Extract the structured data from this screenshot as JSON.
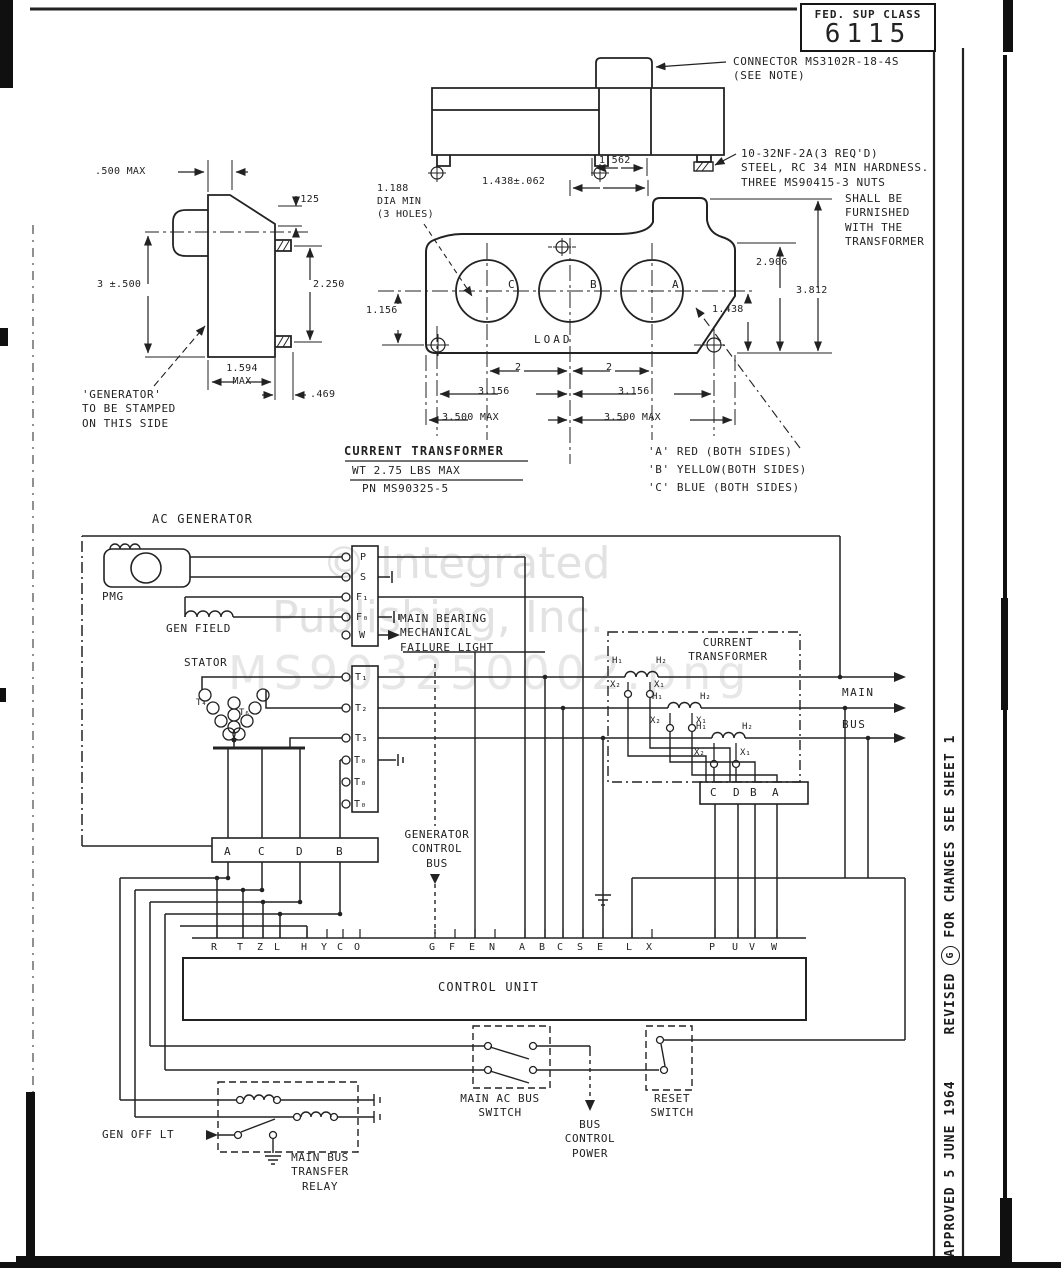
{
  "page": {
    "fed_box": {
      "label": "FED. SUP CLASS",
      "value": "6115"
    },
    "edge_note": {
      "approved": "APPROVED  5 JUNE 1964",
      "revised": "REVISED",
      "rev_letter": "G",
      "for_changes": "FOR CHANGES SEE SHEET 1"
    }
  },
  "watermark": {
    "line1": "© Integrated",
    "line2": "Publishing, Inc.",
    "line3": "MS903250002.png"
  },
  "mech": {
    "connector_callout": "CONNECTOR MS3102R-18-4S\n(SEE NOTE)",
    "stud_callout": "10-32NF-2A(3 REQ'D)\nSTEEL, RC 34 MIN HARDNESS.\nTHREE MS90415-3 NUTS",
    "furnished_note": "SHALL BE\nFURNISHED\nWITH THE\nTRANSFORMER",
    "stamp_note": "'GENERATOR'\nTO BE STAMPED\nON THIS SIDE",
    "hole_note": "1.188\nDIA MIN\n(3 HOLES)",
    "load_label": "LOAD",
    "hole_labels": [
      "C",
      "B",
      "A"
    ],
    "dims": {
      "top_width": "1.562",
      "top_offset": "1.438±.062",
      "side_offset": ".500 MAX",
      "side_step": ".125",
      "side_height": "3 ±.500",
      "stud_spacing": "2.250",
      "side_width": "1.594\nMAX",
      "stud_length": ".469",
      "front_h1": "2.906",
      "front_h2": "3.812",
      "front_left": "1.156",
      "front_right": "1.438",
      "pitch_left": "2",
      "pit8ch_right": "2",
      "pitch_right": "2",
      "span_left": "3.156",
      "span_right": "3.156",
      "max_left": "3.500 MAX",
      "max_right": "3.500 MAX"
    },
    "title": {
      "line1": "CURRENT  TRANSFORMER",
      "line2": "WT 2.75 LBS MAX",
      "line3": "PN MS90325-5"
    },
    "color_code": [
      "'A' RED (BOTH SIDES)",
      "'B' YELLOW(BOTH SIDES)",
      "'C' BLUE (BOTH SIDES)"
    ]
  },
  "schematic": {
    "ac_generator": "AC GENERATOR",
    "pmg": "PMG",
    "gen_field": "GEN FIELD",
    "stator": "STATOR",
    "stator_coil_a": "T₄",
    "stator_coil_b": "T₆",
    "gen_terminals": [
      "P",
      "S",
      "F₁",
      "F₀",
      "W"
    ],
    "t_terminals": [
      "T₁",
      "T₂",
      "T₃",
      "T₀",
      "T₀",
      "T₀"
    ],
    "failure_light": "MAIN BEARING\nMECHANICAL\nFAILURE LIGHT",
    "lower_strip": [
      "A",
      "C",
      "D",
      "B"
    ],
    "ct_title": "CURRENT\nTRANSFORMER",
    "h1": "H₁",
    "h2": "H₂",
    "x1": "X₁",
    "x2": "X₂",
    "ct_strip": [
      "C",
      "D",
      "B",
      "A"
    ],
    "main": "MAIN",
    "bus": "BUS",
    "gen_control_bus": "GENERATOR\nCONTROL\nBUS",
    "control_unit": "CONTROL UNIT",
    "cu_terminals": [
      "R",
      "T",
      "Z",
      "L",
      "H",
      "Y",
      "C",
      "O",
      "G",
      "F",
      "E",
      "N",
      "A",
      "B",
      "C",
      "S",
      "E",
      "L",
      "X",
      "P",
      "U",
      "V",
      "W"
    ],
    "main_ac_bus_switch": "MAIN AC BUS\nSWITCH",
    "reset_switch": "RESET\nSWITCH",
    "bus_control_power": "BUS\nCONTROL\nPOWER",
    "gen_off_lt": "GEN OFF LT",
    "transfer_relay": "MAIN BUS\nTRANSFER\nRELAY"
  }
}
